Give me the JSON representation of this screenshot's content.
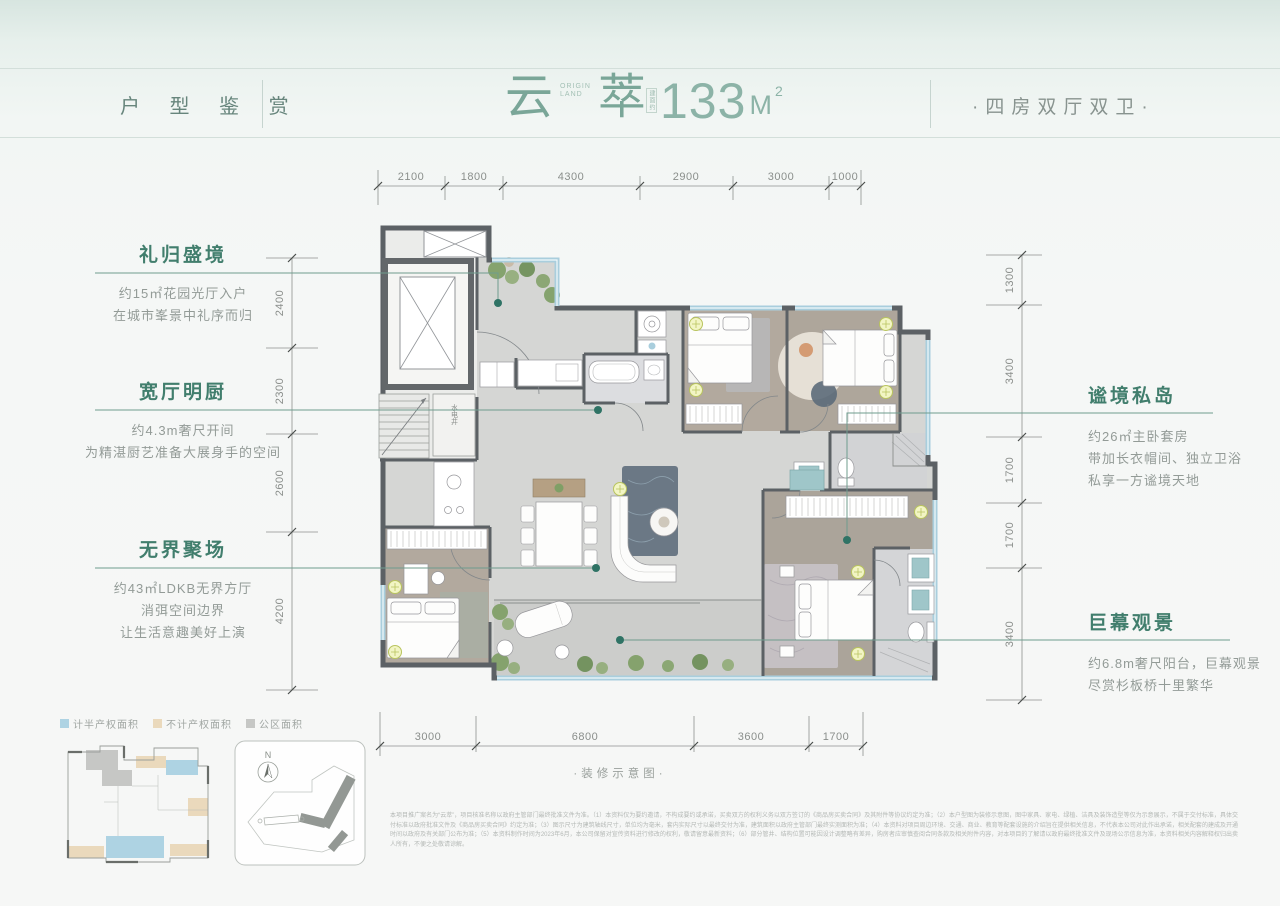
{
  "header": {
    "section_label": "户 型 鉴 赏",
    "name_char1": "云",
    "name_char2": "萃",
    "brand_line1": "ORIGIN",
    "brand_line2": "LAND",
    "area_prefix": "建面约",
    "area_number": "133",
    "area_unit": "M",
    "area_sup": "2",
    "type_label": "·四房双厅双卫·"
  },
  "annotations": {
    "left": [
      {
        "title": "礼归盛境",
        "lines": [
          "约15㎡花园光厅入户",
          "在城市峯景中礼序而归"
        ]
      },
      {
        "title": "宽厅明厨",
        "lines": [
          "约4.3m奢尺开间",
          "为精湛厨艺准备大展身手的空间"
        ]
      },
      {
        "title": "无界聚场",
        "lines": [
          "约43㎡LDKB无界方厅",
          "消弭空间边界",
          "让生活意趣美好上演"
        ]
      }
    ],
    "right": [
      {
        "title": "谧境私岛",
        "lines": [
          "约26㎡主卧套房",
          "带加长衣帽间、独立卫浴",
          "私享一方谧境天地"
        ]
      },
      {
        "title": "巨幕观景",
        "lines": [
          "约6.8m奢尺阳台，巨幕观景",
          "尽赏杉板桥十里繁华"
        ]
      }
    ]
  },
  "dimensions": {
    "top": [
      "2100",
      "1800",
      "4300",
      "2900",
      "3000",
      "1000"
    ],
    "bottom": [
      "3000",
      "6800",
      "3600",
      "1700"
    ],
    "left": [
      "2400",
      "2300",
      "2600",
      "4200"
    ],
    "right": [
      "1300",
      "3400",
      "1700",
      "1700",
      "3400"
    ]
  },
  "plan": {
    "shaft_label": "水电井",
    "compass_label": "N"
  },
  "legend": {
    "items": [
      {
        "label": "计半产权面积",
        "color": "#aed3e3"
      },
      {
        "label": "不计产权面积",
        "color": "#ead9bc"
      },
      {
        "label": "公区面积",
        "color": "#c6c7c5"
      }
    ]
  },
  "caption": "·装修示意图·",
  "disclaimer": "本项目推广案名为“云萃”，项目核准名称以政府主管部门最终批准文件为准。（1）本资料仅为要约邀请，不构成要约或承诺，买卖双方的权利义务以双方签订的《商品房买卖合同》及其附件等协议约定为准；（2）本户型图为装修示意图，图中家具、家电、绿植、洁具及装饰造型等仅为示意展示，不属于交付标准，具体交付标准以政府批准文件及《商品房买卖合同》约定为准；（3）图示尺寸为建筑轴线尺寸，单位均为毫米，套内实际尺寸以最终交付为准，建筑面积以政府主管部门最终实测面积为准；（4）本资料对项目周边环境、交通、商业、教育等配套设施的介绍旨在提供相关信息，不代表本公司对此作出承诺，相关配套的建成及开通时间以政府及有关部门公布为准；（5）本资料制作时间为2023年6月，本公司保留对宣传资料进行修改的权利，敬请留意最新资料；（6）部分管井、结构位置可能因设计调整略有差异，购房者应审慎查阅合同条款及相关附件内容，对本项目的了解请以政府最终批准文件及现场公示信息为准，本资料相关内容解释权归出卖人所有，不便之处敬请谅解。"
}
